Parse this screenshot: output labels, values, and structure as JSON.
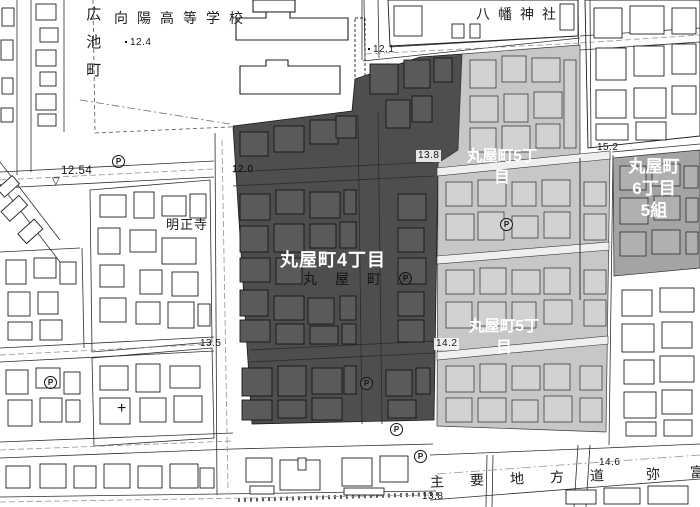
{
  "map": {
    "colors": {
      "district4_fill": "#4e4e4e",
      "district5_fill": "#c7c7c7",
      "district6_fill": "#a4a4a4",
      "line": "#222222",
      "label_white": "#ffffff"
    },
    "districts": {
      "d4": {
        "name": "丸屋町4丁目"
      },
      "d5_top": {
        "line1": "丸屋町5丁",
        "line2": "目"
      },
      "d5_bottom": {
        "line1": "丸屋町5丁",
        "line2": "目"
      },
      "d6": {
        "line1": "丸屋町",
        "line2": "6丁目",
        "line3": "5組"
      }
    },
    "places": {
      "hiroike_cho": "広池町",
      "koyo_high_school": "向陽高等学校",
      "hachiman_shrine": "八幡神社",
      "meishoji_temple": "明正寺",
      "maruya_cho_inline": "丸屋町",
      "main_road": "主要地方道",
      "road_char": "弥",
      "road_char_partial": "富"
    },
    "elevations": {
      "e12_4": "12.4",
      "e12_54": "12.54",
      "e12_1": "12.1",
      "e12_0": "12.0",
      "e13_8a": "13.8",
      "e13_5": "13.5",
      "e13_8b": "13.8",
      "e14_2": "14.2",
      "e14_6": "14.6",
      "e15_2": "15.2"
    },
    "symbols": {
      "parking": "P",
      "survey_cross": "+",
      "benchmark": "▽"
    }
  }
}
